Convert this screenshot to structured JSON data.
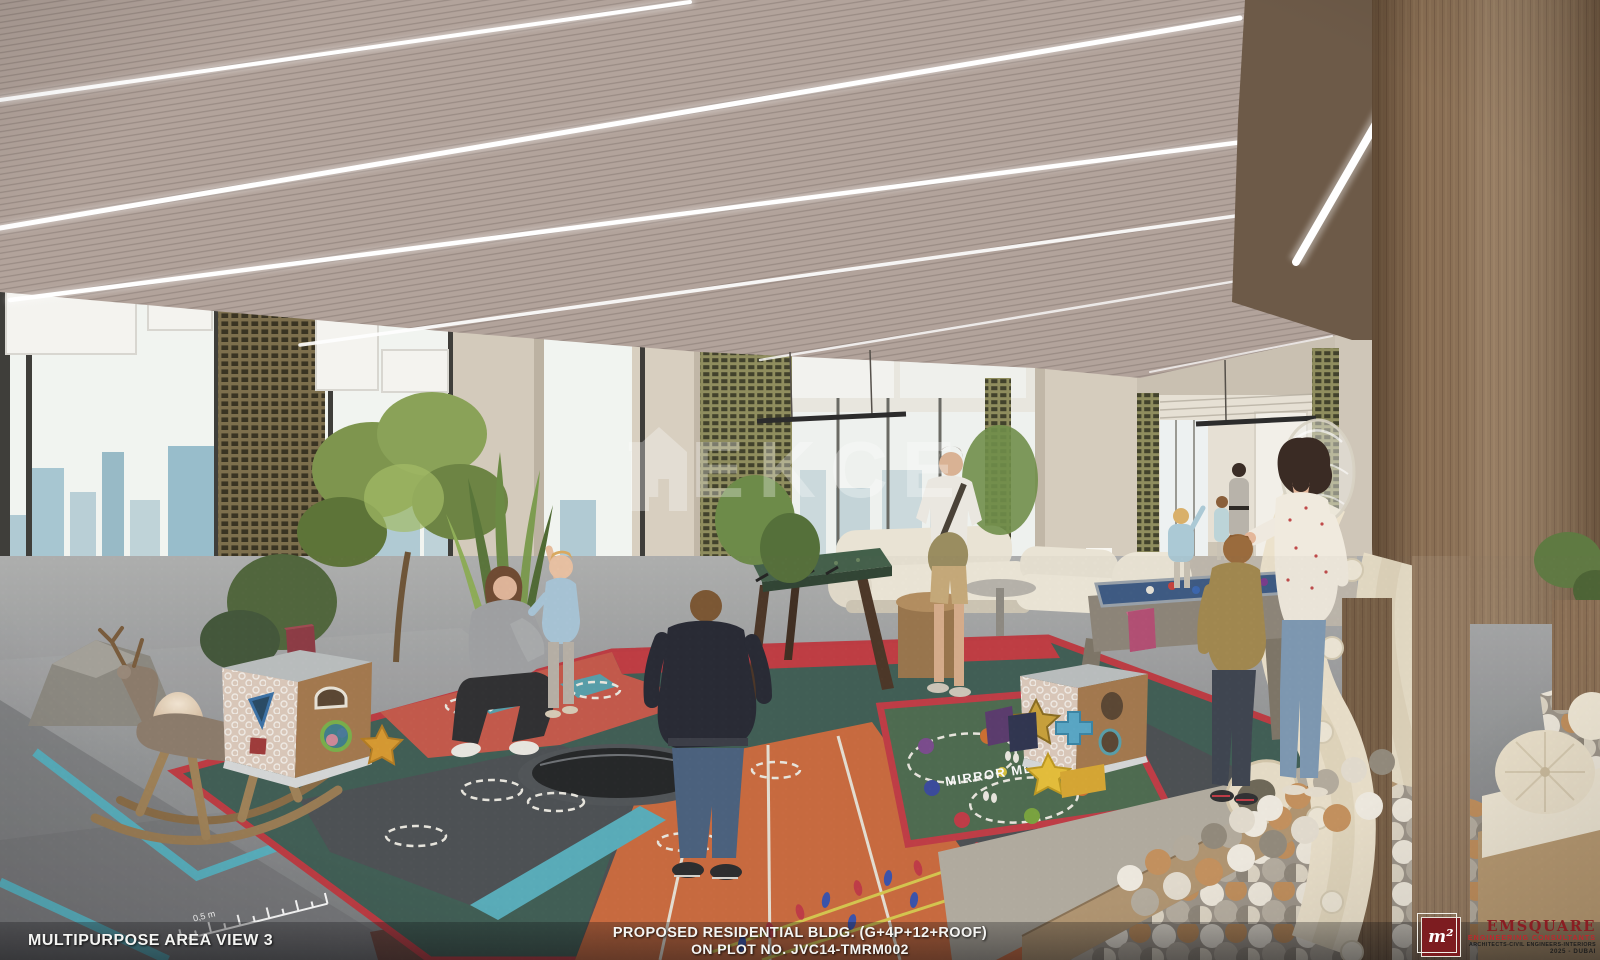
{
  "image": {
    "kind": "architectural-interior-render",
    "width": 1600,
    "height": 960,
    "subject": "children multipurpose play area in residential building"
  },
  "watermark": {
    "text": "TEKCE",
    "icon": "house-icon"
  },
  "footer": {
    "left_label": "MULTIPURPOSE AREA VIEW 3",
    "center_line1": "PROPOSED RESIDENTIAL BLDG. (G+4P+12+ROOF)",
    "center_line2": "ON PLOT NO. JVC14-TMRM002"
  },
  "logo": {
    "symbol": "m²",
    "name": "EMSQUARE",
    "tagline": "ENGINEERING CONSULTANTS",
    "subline": "ARCHITECTS-CIVIL ENGINEERS-INTERIORS",
    "year_city": "2025 - DUBAI"
  },
  "playmat": {
    "game_text": "MIRROR ME",
    "ruler_label": "0,5 m"
  },
  "palette": {
    "ceiling_slats": "#b2a39b",
    "accent_red": "#c23b45",
    "mat_teal": "#3f5e55",
    "track_orange": "#cb6a3e",
    "stripe_teal": "#57b0c0",
    "pool_felt": "#3c5a84",
    "lattice_olive": "#8f8d5e",
    "wood_column": "#8a6f54",
    "logo_maroon": "#7d1c20",
    "logo_red": "#c0272d"
  }
}
